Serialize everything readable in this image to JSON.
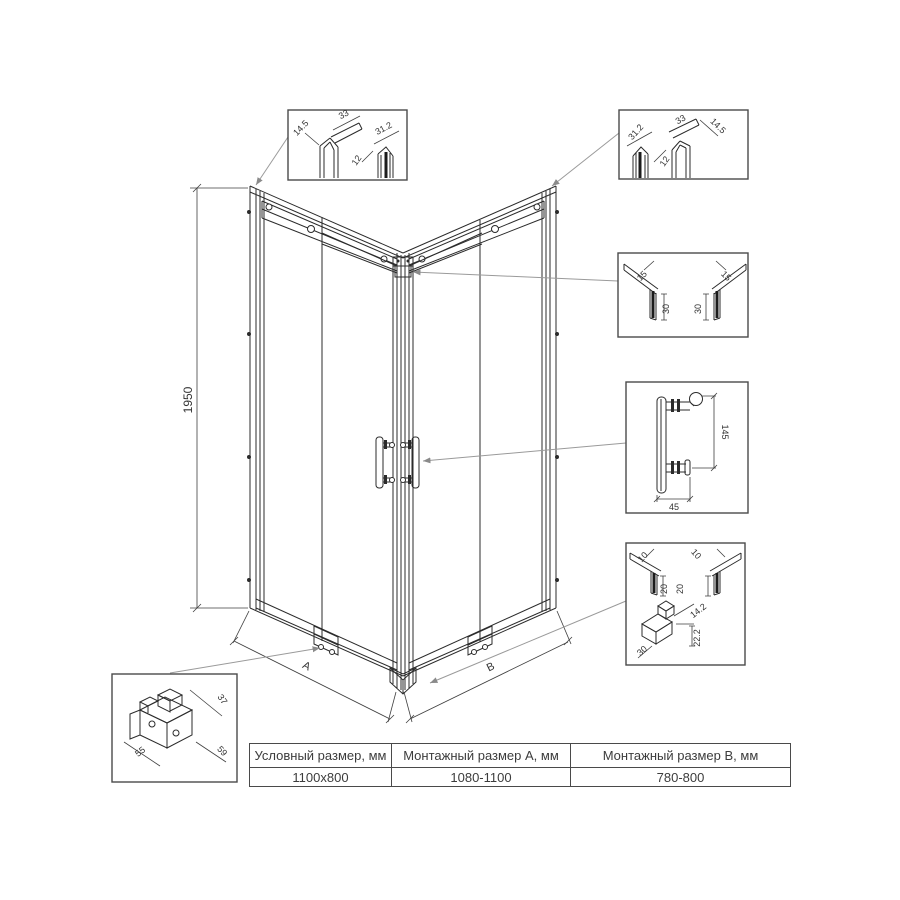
{
  "drawing": {
    "height": "1950",
    "dim_a": "A",
    "dim_b": "B"
  },
  "callouts": {
    "top_left": [
      "14.5",
      "33",
      "12",
      "31.2"
    ],
    "top_right": [
      "31.2",
      "12",
      "33",
      "14.5"
    ],
    "wall_profile": [
      "15",
      "15",
      "30",
      "30"
    ],
    "handle": [
      "145",
      "45"
    ],
    "bottom": [
      "10",
      "10",
      "20",
      "20",
      "14.2",
      "22.2",
      "30"
    ],
    "roller": [
      "37",
      "55",
      "59"
    ]
  },
  "table": {
    "headers": [
      "Условный размер, мм",
      "Монтажный размер A, мм",
      "Монтажный размер B, мм"
    ],
    "row": [
      "1100x800",
      "1080-1100",
      "780-800"
    ]
  }
}
